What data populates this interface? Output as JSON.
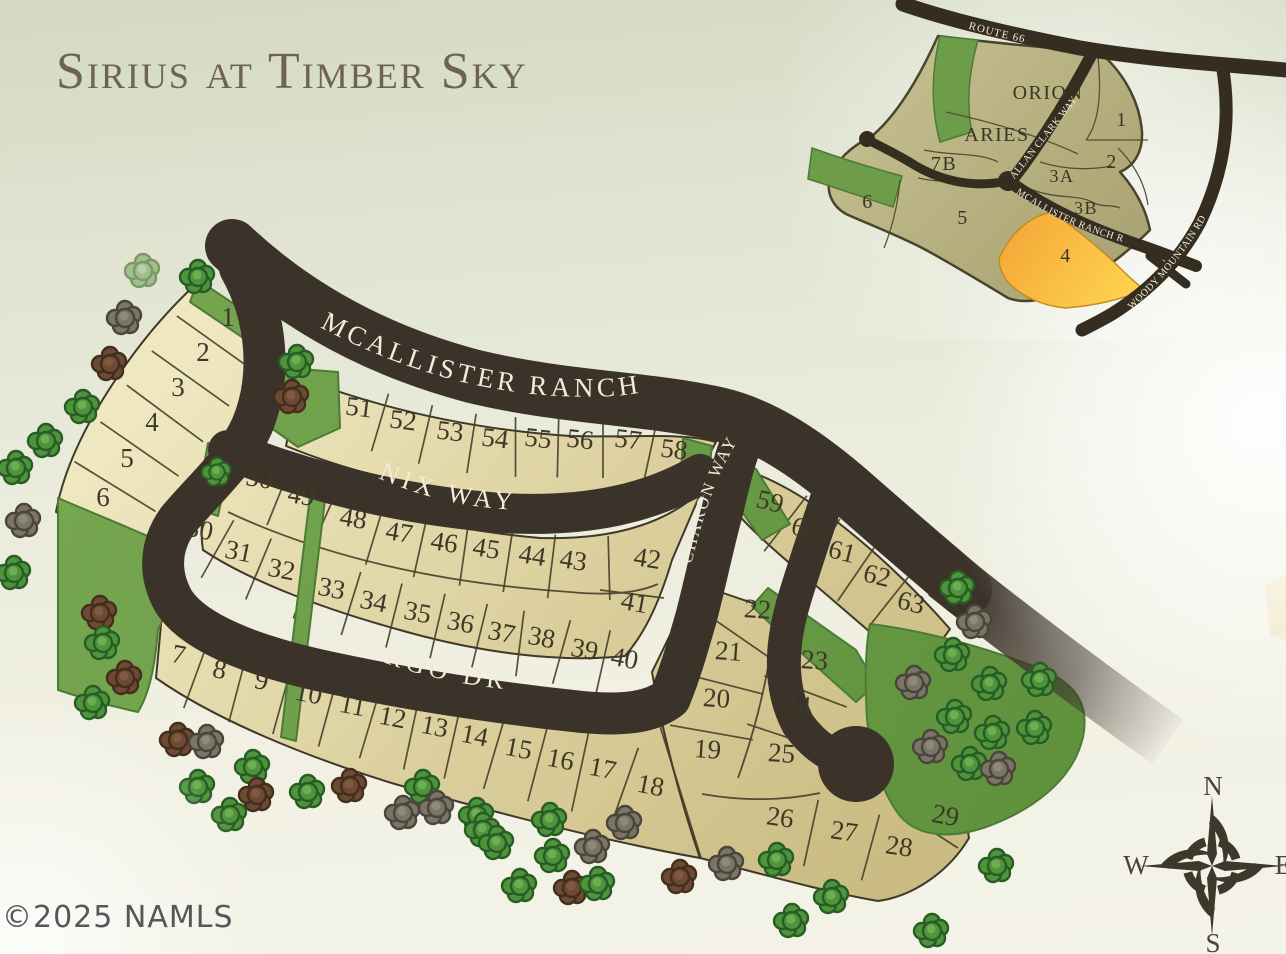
{
  "title": "Sirius at Timber Sky",
  "copyright": "©2025 NAMLS",
  "compass": {
    "north": "N",
    "east": "E",
    "south": "S",
    "west": "W"
  },
  "main_map": {
    "streets": [
      {
        "name": "MCALLISTER RANCH RD",
        "d": "M318,326 C400,370 480,392 560,396 C602,398 628,396 652,390",
        "size": 27,
        "ls": 4
      },
      {
        "name": "NIX WAY",
        "d": "M376,477 C425,499 470,508 520,510",
        "size": 26,
        "ls": 5
      },
      {
        "name": "VIRGO DR",
        "d": "M347,647 C400,672 452,684 514,690",
        "size": 26,
        "ls": 5
      },
      {
        "name": "CHARON WAY",
        "d": "M691,566 C701,523 714,478 740,437",
        "size": 17,
        "ls": 2
      }
    ],
    "rows": [
      {
        "id": "lots-1-6",
        "tilt": 0,
        "div": 95,
        "lots": [
          {
            "n": "1",
            "x": 228,
            "y": 326
          },
          {
            "n": "2",
            "x": 203,
            "y": 361
          },
          {
            "n": "3",
            "x": 178,
            "y": 396
          },
          {
            "n": "4",
            "x": 152,
            "y": 431
          },
          {
            "n": "5",
            "x": 127,
            "y": 467
          },
          {
            "n": "6",
            "x": 103,
            "y": 506
          }
        ]
      },
      {
        "id": "lots-51-58",
        "tilt": 7,
        "div": 60,
        "lots": [
          {
            "n": "51",
            "x": 358,
            "y": 416
          },
          {
            "n": "52",
            "x": 402,
            "y": 429
          },
          {
            "n": "53",
            "x": 449,
            "y": 440
          },
          {
            "n": "54",
            "x": 494,
            "y": 447
          },
          {
            "n": "55",
            "x": 537,
            "y": 447
          },
          {
            "n": "56",
            "x": 579,
            "y": 448
          },
          {
            "n": "57",
            "x": 627,
            "y": 448
          },
          {
            "n": "58",
            "x": 673,
            "y": 458
          }
        ]
      },
      {
        "id": "lots-50-42",
        "tilt": 9,
        "div": 64,
        "lots": [
          {
            "n": "50",
            "x": 258,
            "y": 487
          },
          {
            "n": "49",
            "x": 300,
            "y": 504
          },
          {
            "n": "48",
            "x": 352,
            "y": 527
          },
          {
            "n": "47",
            "x": 398,
            "y": 541
          },
          {
            "n": "46",
            "x": 443,
            "y": 551
          },
          {
            "n": "45",
            "x": 485,
            "y": 557
          },
          {
            "n": "44",
            "x": 531,
            "y": 564
          },
          {
            "n": "43",
            "x": 572,
            "y": 569
          },
          {
            "n": "42",
            "x": 646,
            "y": 567
          }
        ]
      },
      {
        "id": "lots-30-40",
        "tilt": 11,
        "div": 66,
        "lots": [
          {
            "n": "30",
            "x": 198,
            "y": 538
          },
          {
            "n": "31",
            "x": 237,
            "y": 560
          },
          {
            "n": "32",
            "x": 280,
            "y": 578
          },
          {
            "n": "33",
            "x": 330,
            "y": 597
          },
          {
            "n": "34",
            "x": 372,
            "y": 610
          },
          {
            "n": "35",
            "x": 416,
            "y": 621
          },
          {
            "n": "36",
            "x": 459,
            "y": 631
          },
          {
            "n": "37",
            "x": 500,
            "y": 641
          },
          {
            "n": "38",
            "x": 540,
            "y": 646
          },
          {
            "n": "39",
            "x": 583,
            "y": 658
          },
          {
            "n": "40",
            "x": 623,
            "y": 667
          }
        ]
      },
      {
        "id": "lot-41",
        "tilt": 10,
        "div": 0,
        "lots": [
          {
            "n": "41",
            "x": 633,
            "y": 611
          }
        ]
      },
      {
        "id": "lots-7-18",
        "tilt": 11,
        "div": 80,
        "lots": [
          {
            "n": "7",
            "x": 177,
            "y": 663
          },
          {
            "n": "8",
            "x": 218,
            "y": 678
          },
          {
            "n": "9",
            "x": 260,
            "y": 689
          },
          {
            "n": "10",
            "x": 307,
            "y": 702
          },
          {
            "n": "11",
            "x": 351,
            "y": 714
          },
          {
            "n": "12",
            "x": 391,
            "y": 726
          },
          {
            "n": "13",
            "x": 433,
            "y": 735
          },
          {
            "n": "14",
            "x": 473,
            "y": 744
          },
          {
            "n": "15",
            "x": 517,
            "y": 757
          },
          {
            "n": "16",
            "x": 559,
            "y": 768
          },
          {
            "n": "17",
            "x": 601,
            "y": 777
          },
          {
            "n": "18",
            "x": 649,
            "y": 794
          }
        ]
      },
      {
        "id": "lots-59-63",
        "tilt": 14,
        "div": 70,
        "lots": [
          {
            "n": "59",
            "x": 768,
            "y": 510
          },
          {
            "n": "60",
            "x": 803,
            "y": 537
          },
          {
            "n": "61",
            "x": 840,
            "y": 560
          },
          {
            "n": "62",
            "x": 875,
            "y": 584
          },
          {
            "n": "63",
            "x": 909,
            "y": 611
          }
        ]
      },
      {
        "id": "lots-22-19",
        "tilt": 4,
        "div": 84,
        "lots": [
          {
            "n": "22",
            "x": 757,
            "y": 618
          },
          {
            "n": "21",
            "x": 728,
            "y": 660
          },
          {
            "n": "20",
            "x": 716,
            "y": 707
          },
          {
            "n": "19",
            "x": 707,
            "y": 758
          }
        ]
      },
      {
        "id": "lots-23-25",
        "tilt": 4,
        "div": 88,
        "lots": [
          {
            "n": "23",
            "x": 814,
            "y": 669
          },
          {
            "n": "24",
            "x": 797,
            "y": 714
          },
          {
            "n": "25",
            "x": 781,
            "y": 762
          }
        ]
      },
      {
        "id": "lots-26-28",
        "tilt": 8,
        "div": 68,
        "lots": [
          {
            "n": "26",
            "x": 779,
            "y": 826
          },
          {
            "n": "27",
            "x": 843,
            "y": 840
          },
          {
            "n": "28",
            "x": 898,
            "y": 855
          }
        ]
      },
      {
        "id": "lot-29",
        "tilt": 10,
        "div": 0,
        "lots": [
          {
            "n": "29",
            "x": 944,
            "y": 824
          }
        ]
      }
    ],
    "trees": [
      {
        "x": 143,
        "y": 271,
        "c": "lg"
      },
      {
        "x": 198,
        "y": 277,
        "c": "g"
      },
      {
        "x": 125,
        "y": 318,
        "c": "gy"
      },
      {
        "x": 110,
        "y": 364,
        "c": "br"
      },
      {
        "x": 83,
        "y": 407,
        "c": "g"
      },
      {
        "x": 46,
        "y": 441,
        "c": "g"
      },
      {
        "x": 16,
        "y": 468,
        "c": "g"
      },
      {
        "x": 24,
        "y": 521,
        "c": "gy"
      },
      {
        "x": 14,
        "y": 573,
        "c": "g"
      },
      {
        "x": 100,
        "y": 613,
        "c": "br"
      },
      {
        "x": 103,
        "y": 643,
        "c": "g"
      },
      {
        "x": 125,
        "y": 678,
        "c": "br"
      },
      {
        "x": 93,
        "y": 703,
        "c": "g"
      },
      {
        "x": 297,
        "y": 362,
        "c": "g"
      },
      {
        "x": 292,
        "y": 397,
        "c": "br"
      },
      {
        "x": 217,
        "y": 472,
        "c": "g",
        "s": 0.85
      },
      {
        "x": 178,
        "y": 740,
        "c": "br"
      },
      {
        "x": 207,
        "y": 742,
        "c": "gy"
      },
      {
        "x": 253,
        "y": 767,
        "c": "g"
      },
      {
        "x": 198,
        "y": 787,
        "c": "g"
      },
      {
        "x": 257,
        "y": 795,
        "c": "br"
      },
      {
        "x": 230,
        "y": 815,
        "c": "g"
      },
      {
        "x": 308,
        "y": 792,
        "c": "g"
      },
      {
        "x": 350,
        "y": 786,
        "c": "br"
      },
      {
        "x": 423,
        "y": 787,
        "c": "g"
      },
      {
        "x": 403,
        "y": 813,
        "c": "gy"
      },
      {
        "x": 437,
        "y": 808,
        "c": "gy"
      },
      {
        "x": 477,
        "y": 815,
        "c": "g"
      },
      {
        "x": 483,
        "y": 830,
        "c": "g"
      },
      {
        "x": 497,
        "y": 843,
        "c": "g"
      },
      {
        "x": 550,
        "y": 820,
        "c": "g"
      },
      {
        "x": 553,
        "y": 856,
        "c": "g"
      },
      {
        "x": 520,
        "y": 886,
        "c": "g"
      },
      {
        "x": 572,
        "y": 888,
        "c": "br"
      },
      {
        "x": 598,
        "y": 884,
        "c": "g"
      },
      {
        "x": 593,
        "y": 847,
        "c": "gy"
      },
      {
        "x": 625,
        "y": 823,
        "c": "gy"
      },
      {
        "x": 680,
        "y": 877,
        "c": "br"
      },
      {
        "x": 727,
        "y": 864,
        "c": "gy"
      },
      {
        "x": 777,
        "y": 860,
        "c": "g"
      },
      {
        "x": 832,
        "y": 897,
        "c": "g"
      },
      {
        "x": 792,
        "y": 921,
        "c": "g"
      },
      {
        "x": 932,
        "y": 931,
        "c": "g"
      },
      {
        "x": 997,
        "y": 866,
        "c": "g"
      },
      {
        "x": 958,
        "y": 588,
        "c": "g"
      },
      {
        "x": 975,
        "y": 622,
        "c": "gy"
      },
      {
        "x": 953,
        "y": 655,
        "c": "g"
      },
      {
        "x": 914,
        "y": 683,
        "c": "gy"
      },
      {
        "x": 990,
        "y": 684,
        "c": "g"
      },
      {
        "x": 1040,
        "y": 680,
        "c": "g"
      },
      {
        "x": 955,
        "y": 717,
        "c": "g"
      },
      {
        "x": 993,
        "y": 733,
        "c": "g"
      },
      {
        "x": 1035,
        "y": 728,
        "c": "g"
      },
      {
        "x": 931,
        "y": 747,
        "c": "gy"
      },
      {
        "x": 970,
        "y": 764,
        "c": "g"
      },
      {
        "x": 999,
        "y": 769,
        "c": "gy"
      }
    ]
  },
  "inset_map": {
    "streets": [
      {
        "name": "ROUTE 66",
        "d": "M966,28 C1008,40 1042,47 1080,52",
        "size": 11,
        "ls": 1
      },
      {
        "name": "ALLAN CLARK WAY",
        "d": "M1013,181 L1101,70",
        "size": 10,
        "ls": 0.5
      },
      {
        "name": "MCALLISTER RANCH RD",
        "d": "M1014,192 C1050,217 1084,231 1126,243",
        "size": 10,
        "ls": 0.5
      },
      {
        "name": "WOODY MOUNTAIN RD",
        "d": "M1130,311 C1168,275 1196,241 1217,196",
        "size": 10,
        "ls": 0.5
      }
    ],
    "parcels": [
      {
        "label": "ORION",
        "x": 1048,
        "y": 99,
        "size": 20
      },
      {
        "label": "ARIES",
        "x": 997,
        "y": 141,
        "size": 20
      },
      {
        "label": "7B",
        "x": 944,
        "y": 170,
        "size": 20
      },
      {
        "label": "1",
        "x": 1122,
        "y": 126,
        "size": 20
      },
      {
        "label": "2",
        "x": 1112,
        "y": 168,
        "size": 20
      },
      {
        "label": "3A",
        "x": 1062,
        "y": 182,
        "size": 18
      },
      {
        "label": "3B",
        "x": 1086,
        "y": 214,
        "size": 18
      },
      {
        "label": "5",
        "x": 963,
        "y": 224,
        "size": 20
      },
      {
        "label": "6",
        "x": 868,
        "y": 208,
        "size": 20
      },
      {
        "label": "4",
        "x": 1066,
        "y": 262,
        "size": 20,
        "highlighted": true
      }
    ]
  }
}
